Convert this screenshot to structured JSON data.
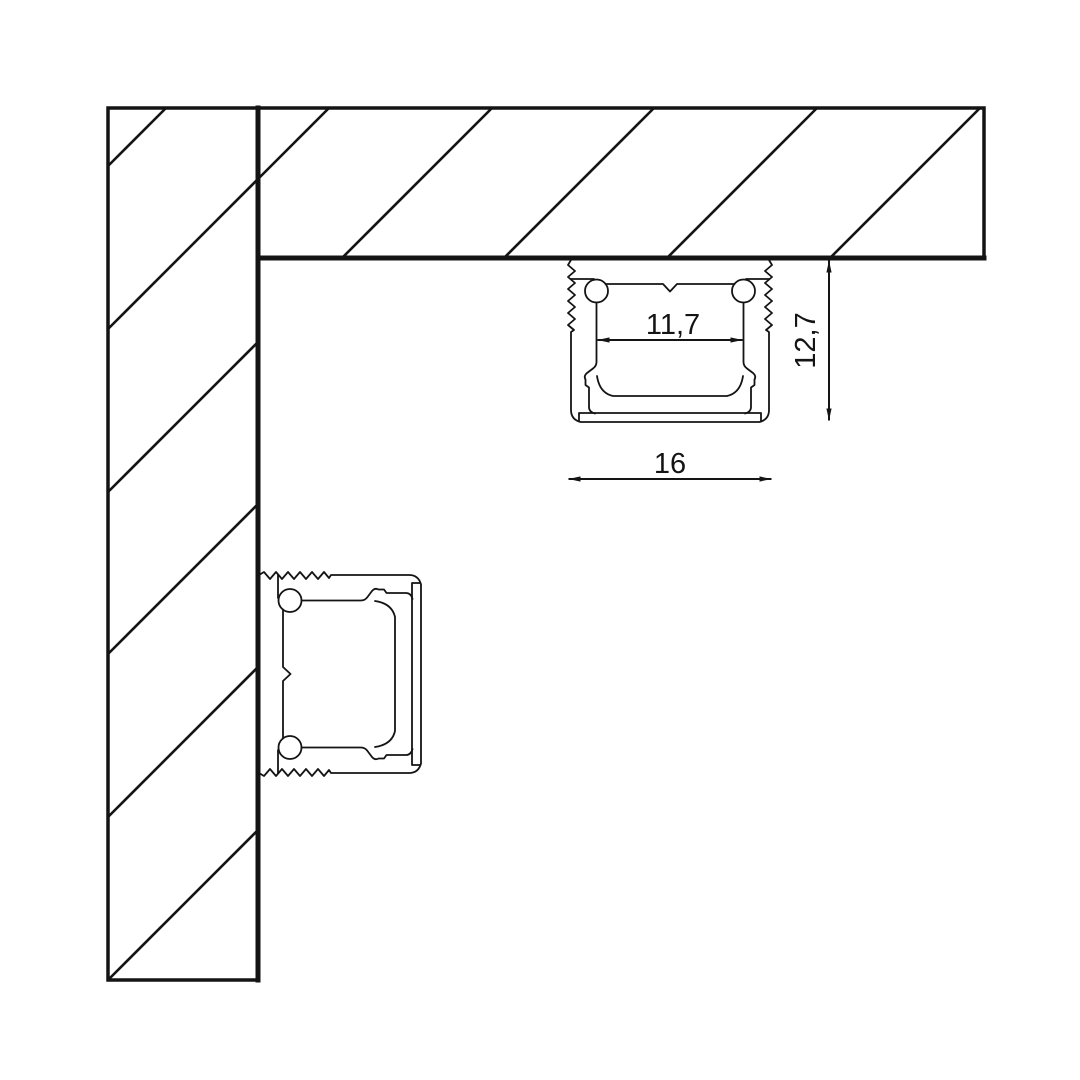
{
  "diagram": {
    "kind": "led-aluminium-profile-mounting-cross-section",
    "background_color": "#ffffff",
    "line_color": "#141414",
    "labels": {
      "inner_width": "11,7",
      "height": "12,7",
      "outer_width": "16"
    }
  }
}
